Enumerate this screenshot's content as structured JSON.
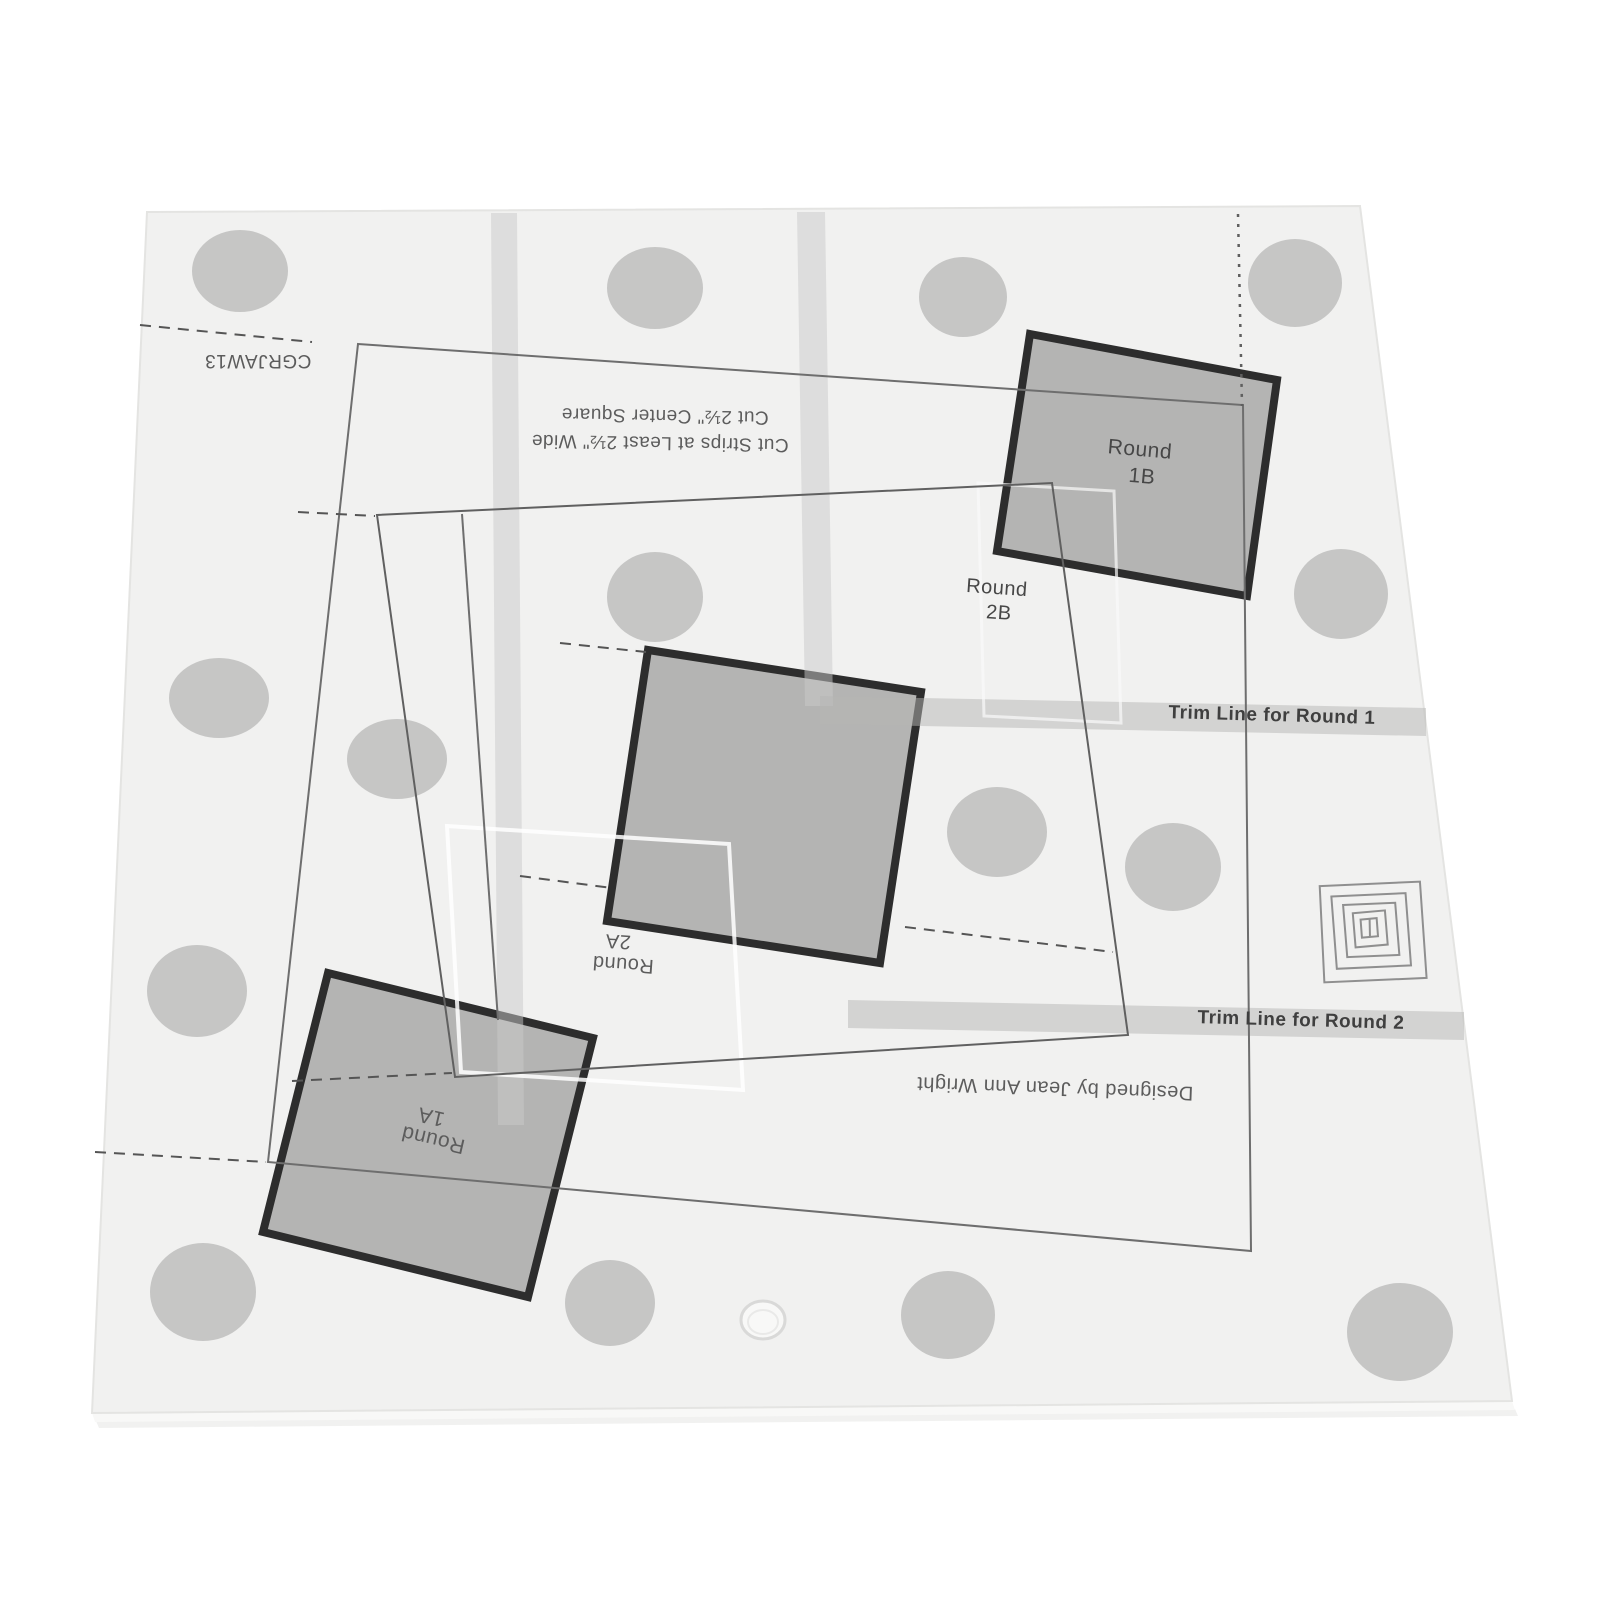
{
  "colors": {
    "background": "#ffffff",
    "sheet": "#f1f1f0",
    "dot": "#c6c6c5",
    "band": "#c9c9c9",
    "trim_band": "#b5b5b4",
    "patch_fill": "#b4b4b3",
    "patch_border": "#2d2d2d",
    "line": "#6e6e6e",
    "text": "#474747"
  },
  "sheet": {
    "code": "CGRJAW13",
    "instructions": {
      "line1": "Cut 2½\" Center Square",
      "line2": "Cut Strips at Least 2½\" Wide"
    },
    "trim_line_1": "Trim Line for Round 1",
    "trim_line_2": "Trim Line for Round 2",
    "credit": "Designed by Jean Ann Wright",
    "patches": {
      "round_1a": {
        "line1": "Round",
        "line2": "1A"
      },
      "round_1b": {
        "line1": "Round",
        "line2": "1B"
      },
      "round_2a": {
        "line1": "Round",
        "line2": "2A"
      },
      "round_2b": {
        "line1": "Round",
        "line2": "2B"
      }
    }
  }
}
